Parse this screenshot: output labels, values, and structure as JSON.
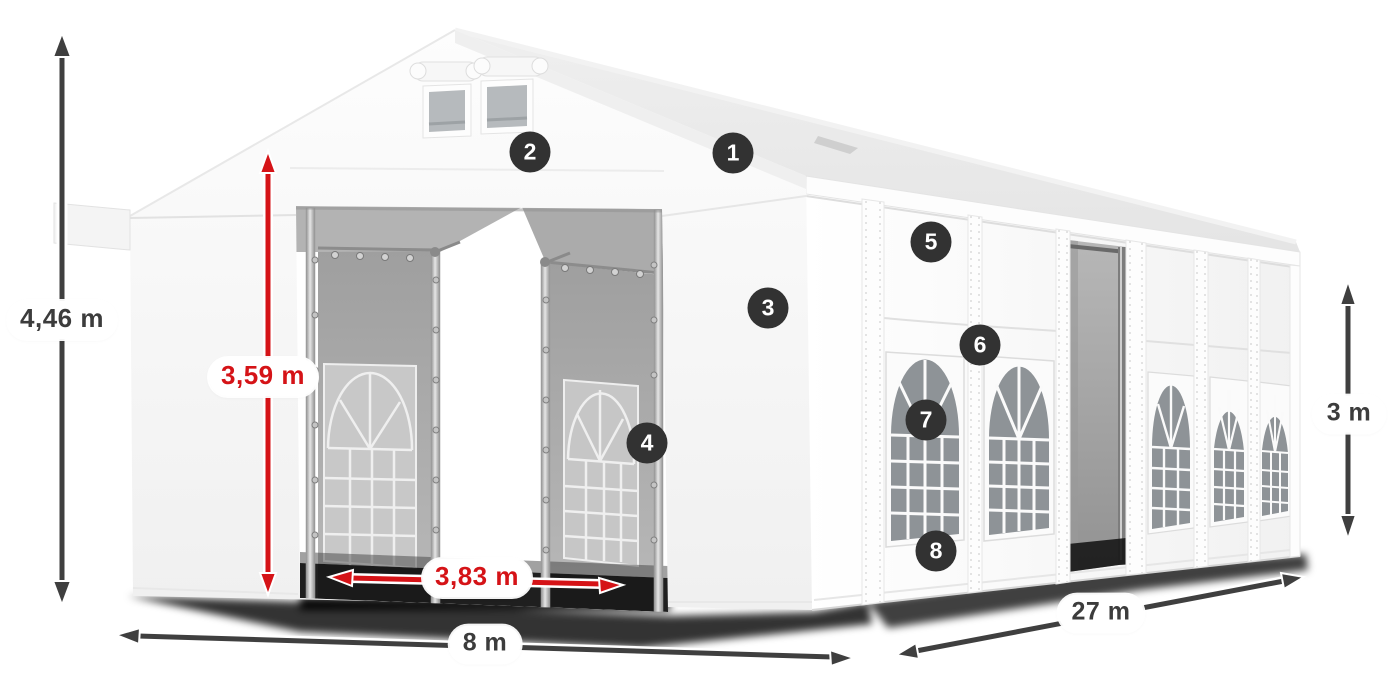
{
  "diagram": {
    "title": "tent-dimensions-diagram",
    "labels": {
      "total_height": "4,46 m",
      "entrance_height": "3,59 m",
      "entrance_width": "3,83 m",
      "front_width": "8 m",
      "length": "27 m",
      "side_height": "3 m"
    },
    "hotspots": [
      {
        "number": "1"
      },
      {
        "number": "2"
      },
      {
        "number": "3"
      },
      {
        "number": "4"
      },
      {
        "number": "5"
      },
      {
        "number": "6"
      },
      {
        "number": "7"
      },
      {
        "number": "8"
      }
    ],
    "colors": {
      "dimension_dark": "#3f3f3f",
      "dimension_red": "#d51317",
      "hotspot_bg": "#323232",
      "hotspot_text": "#ffffff",
      "label_bg": "#ffffff",
      "label_text": "#3c3c3c",
      "tent_white": "#f7f7f7",
      "glass_gray": "#8e9397"
    }
  }
}
